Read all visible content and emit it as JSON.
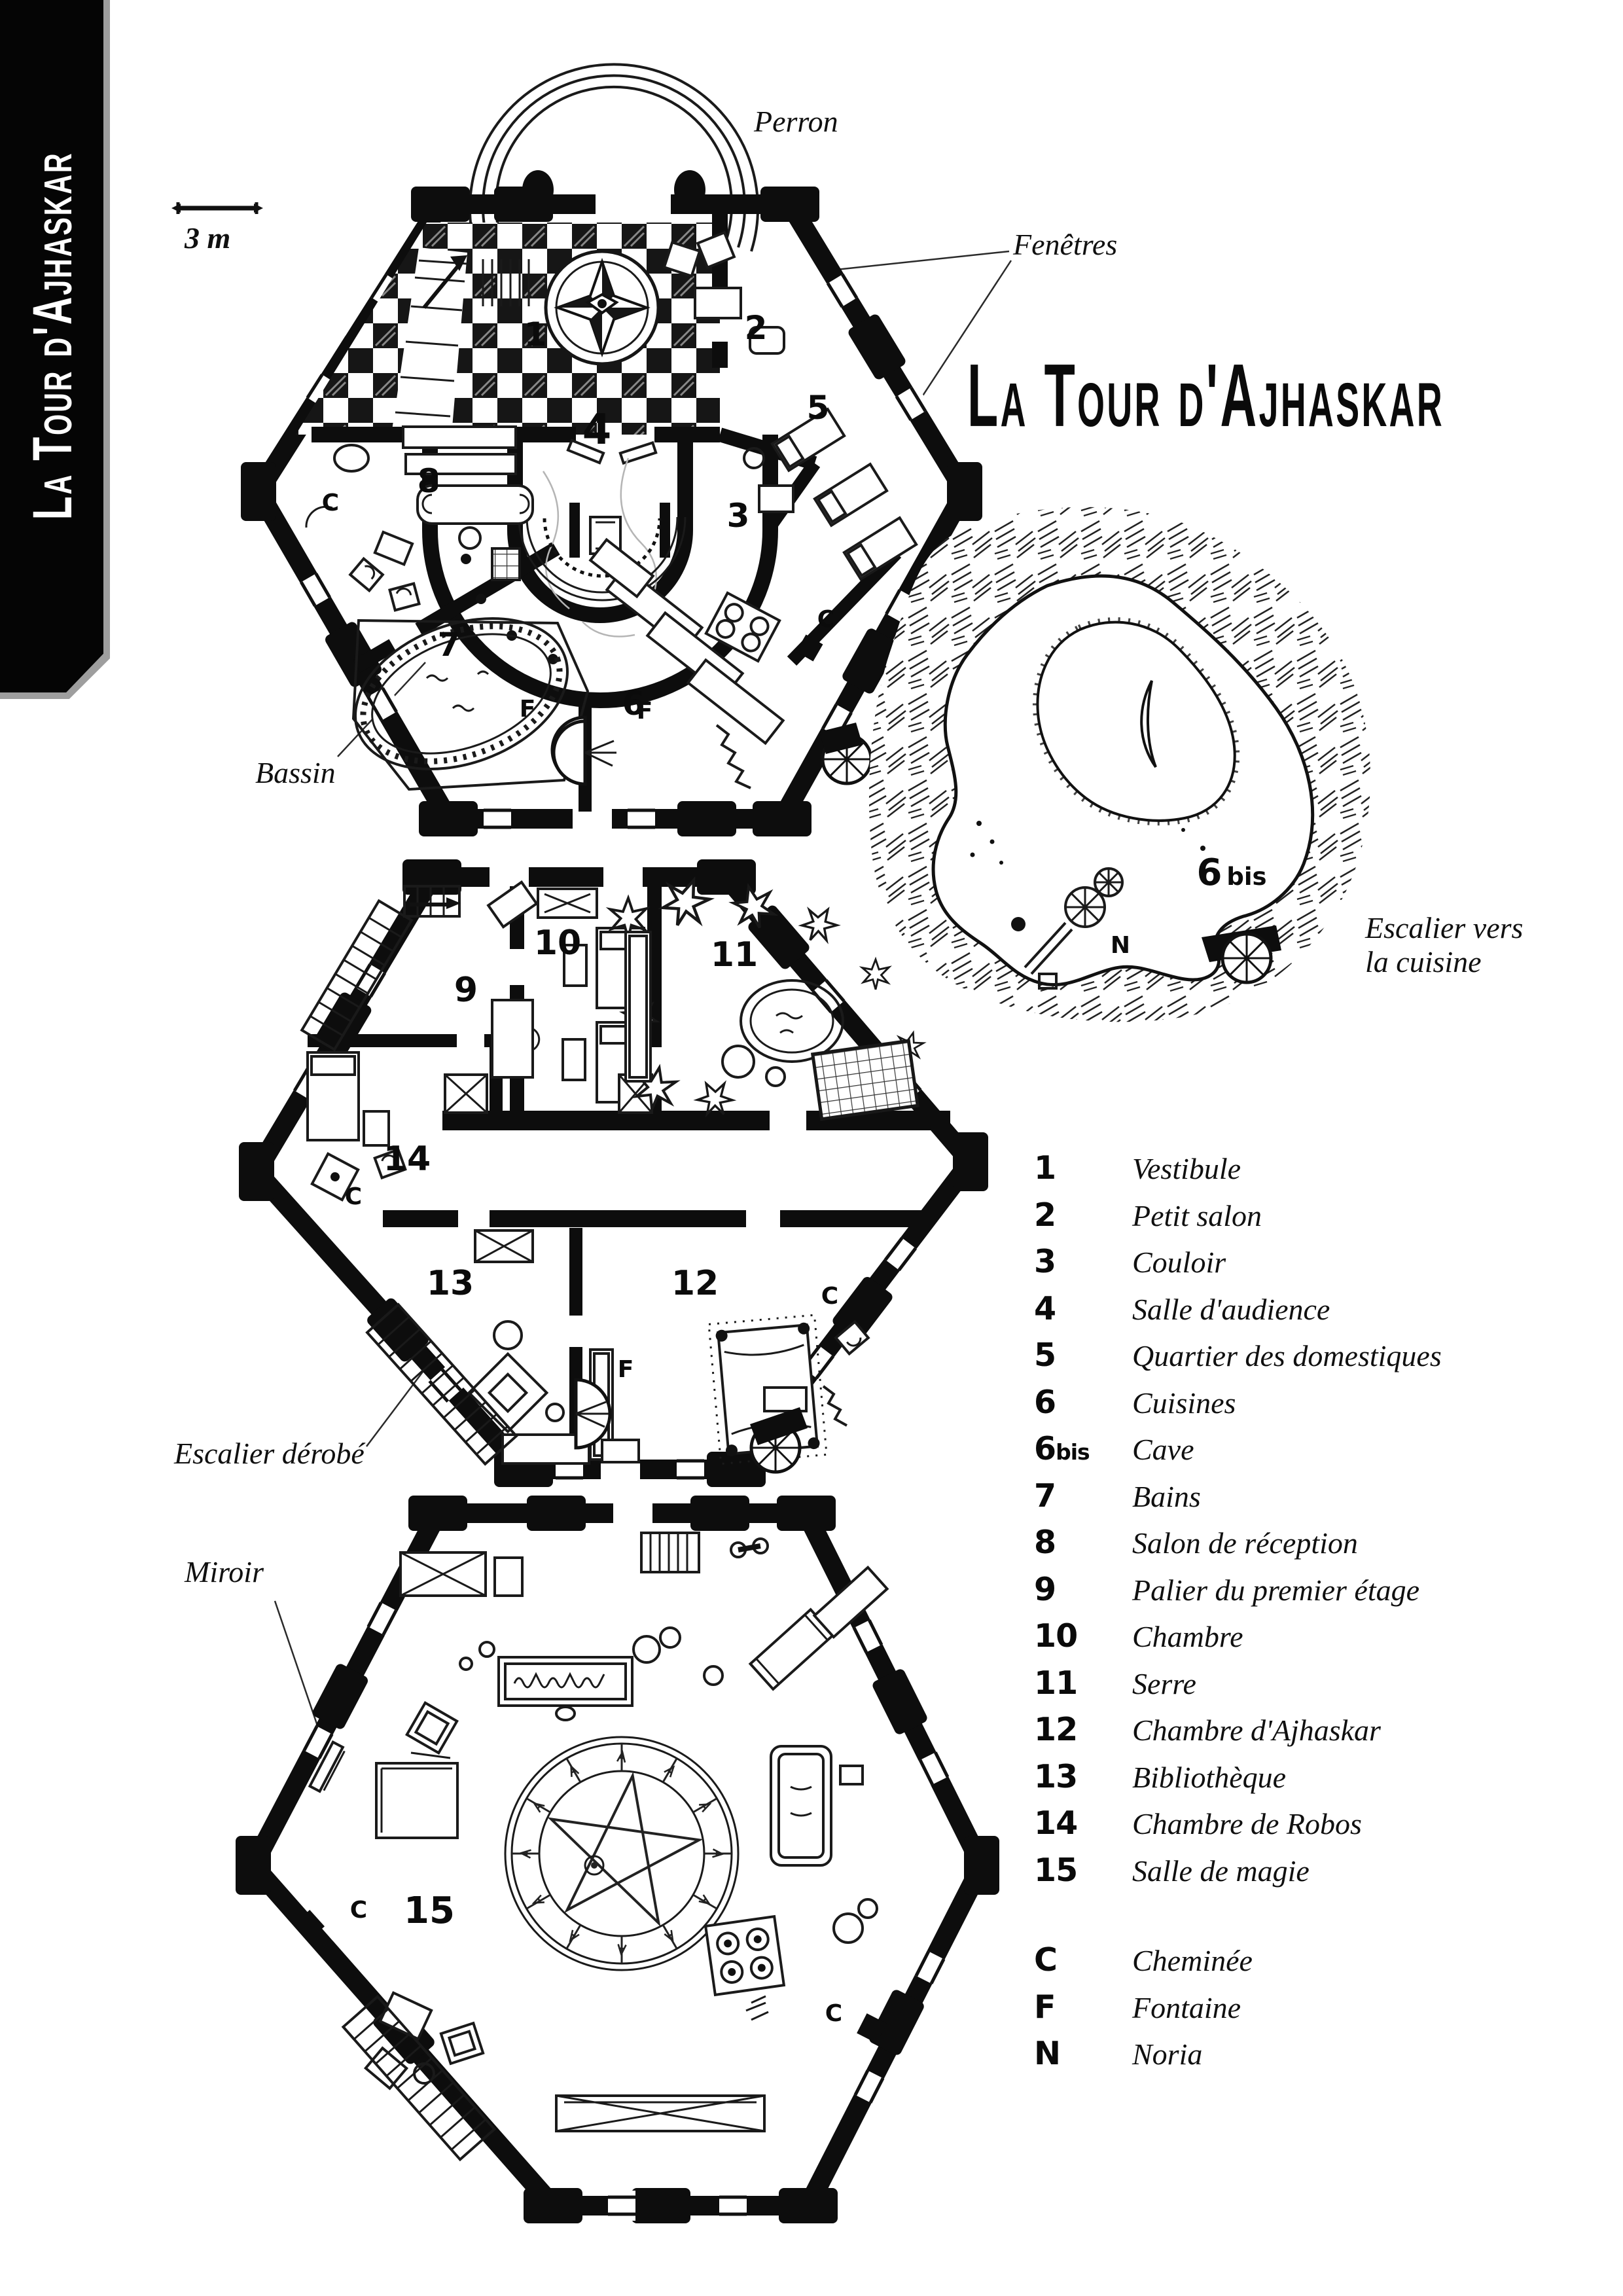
{
  "sidebar": {
    "title": "La Tour d'Ajhaskar"
  },
  "header": {
    "title": "La Tour d'Ajhaskar"
  },
  "scale": {
    "label": "3 m"
  },
  "callouts": {
    "perron": "Perron",
    "fenetres": "Fenêtres",
    "bassin": "Bassin",
    "escalier_cuisine_line1": "Escalier vers",
    "escalier_cuisine_line2": "la cuisine",
    "escalier_derobe": "Escalier dérobé",
    "miroir": "Miroir"
  },
  "plans": {
    "ground": {
      "numbers": [
        "1",
        "2",
        "3",
        "4",
        "5",
        "6",
        "7",
        "8"
      ],
      "letters": [
        "C",
        "C",
        "F",
        "F"
      ]
    },
    "middle": {
      "numbers": [
        "9",
        "10",
        "11",
        "12",
        "13",
        "14"
      ],
      "letters": [
        "C",
        "C",
        "F"
      ]
    },
    "bottom": {
      "numbers": [
        "15"
      ],
      "letters": [
        "C",
        "C"
      ]
    },
    "cave": {
      "number": "6",
      "suffix": "bis",
      "letter": "N"
    }
  },
  "legend": {
    "rooms": [
      {
        "num": "1",
        "suffix": "",
        "label": "Vestibule"
      },
      {
        "num": "2",
        "suffix": "",
        "label": "Petit salon"
      },
      {
        "num": "3",
        "suffix": "",
        "label": "Couloir"
      },
      {
        "num": "4",
        "suffix": "",
        "label": "Salle d'audience"
      },
      {
        "num": "5",
        "suffix": "",
        "label": "Quartier des domestiques"
      },
      {
        "num": "6",
        "suffix": "",
        "label": "Cuisines"
      },
      {
        "num": "6",
        "suffix": "bis",
        "label": "Cave"
      },
      {
        "num": "7",
        "suffix": "",
        "label": "Bains"
      },
      {
        "num": "8",
        "suffix": "",
        "label": "Salon de réception"
      },
      {
        "num": "9",
        "suffix": "",
        "label": "Palier du premier étage"
      },
      {
        "num": "10",
        "suffix": "",
        "label": "Chambre"
      },
      {
        "num": "11",
        "suffix": "",
        "label": "Serre"
      },
      {
        "num": "12",
        "suffix": "",
        "label": "Chambre d'Ajhaskar"
      },
      {
        "num": "13",
        "suffix": "",
        "label": "Bibliothèque"
      },
      {
        "num": "14",
        "suffix": "",
        "label": "Chambre de Robos"
      },
      {
        "num": "15",
        "suffix": "",
        "label": "Salle de magie"
      }
    ],
    "symbols": [
      {
        "num": "C",
        "label": "Cheminée"
      },
      {
        "num": "F",
        "label": "Fontaine"
      },
      {
        "num": "N",
        "label": "Noria"
      }
    ]
  }
}
